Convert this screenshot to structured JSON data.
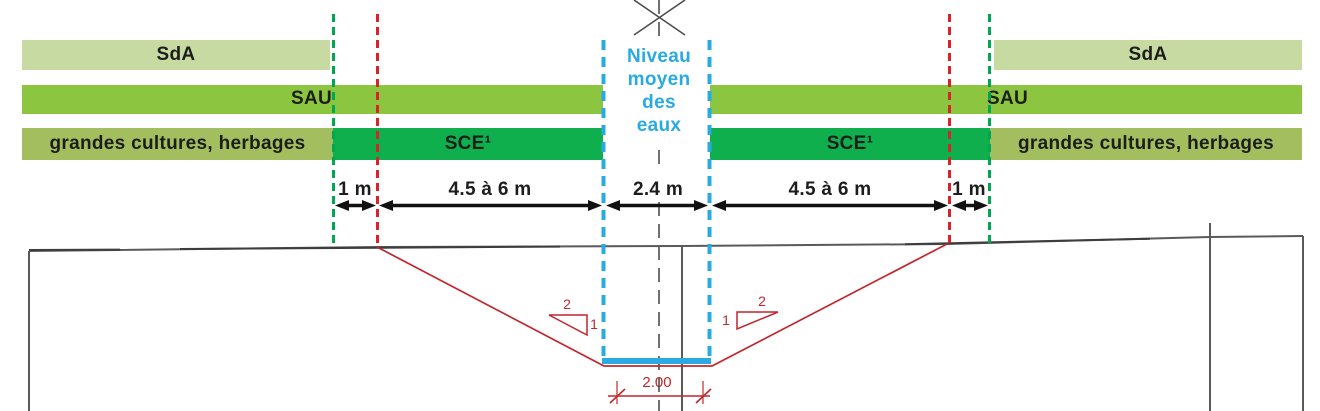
{
  "zones": {
    "sda_left": "SdA",
    "sda_right": "SdA",
    "sau_left": "SAU",
    "sau_right": "SAU",
    "cultures_left": "grandes cultures, herbages",
    "cultures_right": "grandes cultures, herbages",
    "sce_left": "SCE¹",
    "sce_right": "SCE¹"
  },
  "water_level_label": "Niveau\nmoyen\ndes\neaux",
  "measurements": {
    "buffer_left": "1 m",
    "field_left": "4.5 à 6 m",
    "water_width": "2.4 m",
    "field_right": "4.5 à 6 m",
    "buffer_right": "1 m"
  },
  "slopes": {
    "left": {
      "horizontal": "2",
      "vertical": "1"
    },
    "right": {
      "horizontal": "2",
      "vertical": "1"
    }
  },
  "dimension_bottom_width": "2.00",
  "colors": {
    "sda_bar": "#c7daa1",
    "sau_bar": "#8cc640",
    "cultures_bar": "#a3be5e",
    "sce_bar": "#0faf4d",
    "water_blue": "#29abe2",
    "boundary_green_dash": "#00a651",
    "boundary_red_dash": "#d8232a",
    "drawing_red": "#c1272d",
    "terrain_gray": "#5a5a5a",
    "text_dark": "#1d1d1b"
  }
}
